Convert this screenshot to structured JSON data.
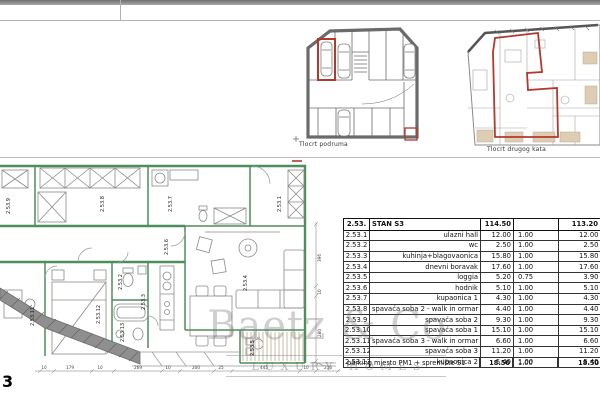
{
  "page_number": "3",
  "sheet": {
    "basement_plan_label": "Tlocrt podruma",
    "second_floor_plan_label": "Tlocrt drugog kata"
  },
  "watermark": {
    "brand": "Baetz & Co",
    "tagline": "LUXURY HOMES"
  },
  "colors": {
    "highlight_red": "#b03a2e",
    "wall_green": "#4e8d5c",
    "watermark_gray": "#9a9a9a"
  },
  "main_plan": {
    "room_labels": [
      "2.53.9",
      "2.53.8",
      "2.53.7",
      "2.53.1",
      "2.53.6",
      "2.53.4",
      "2.53.3",
      "2.53.2",
      "2.53.12",
      "2.53.11",
      "2.53.13",
      "2.53.5"
    ],
    "dims_bottom": [
      "10",
      "179",
      "10",
      "269",
      "10",
      "200",
      "25",
      "445",
      "10",
      "216"
    ],
    "dims_right": [
      "396",
      "10",
      "280"
    ]
  },
  "table": {
    "header": {
      "code": "2.53.",
      "name": "STAN S3",
      "area": "114.50",
      "coef": "",
      "net": "113.20"
    },
    "rows": [
      {
        "code": "2.53.1",
        "name": "ulazni hall",
        "area": "12.00",
        "coef": "1.00",
        "net": "12.00"
      },
      {
        "code": "2.53.2",
        "name": "wc",
        "area": "2.50",
        "coef": "1.00",
        "net": "2.50"
      },
      {
        "code": "2.53.3",
        "name": "kuhinja+blagovaonica",
        "area": "15.80",
        "coef": "1.00",
        "net": "15.80"
      },
      {
        "code": "2.53.4",
        "name": "dnevni boravak",
        "area": "17.60",
        "coef": "1.00",
        "net": "17.60"
      },
      {
        "code": "2.53.5",
        "name": "loggia",
        "area": "5.20",
        "coef": "0.75",
        "net": "3.90"
      },
      {
        "code": "2.53.6",
        "name": "hodnik",
        "area": "5.10",
        "coef": "1.00",
        "net": "5.10"
      },
      {
        "code": "2.53.7",
        "name": "kupaonica 1",
        "area": "4.30",
        "coef": "1.00",
        "net": "4.30"
      },
      {
        "code": "2.53.8",
        "name": "spavaća soba 2 - walk in ormar",
        "area": "4.40",
        "coef": "1.00",
        "net": "4.40"
      },
      {
        "code": "2.53.9",
        "name": "spavaća soba 2",
        "area": "9.30",
        "coef": "1.00",
        "net": "9.30"
      },
      {
        "code": "2.53.10",
        "name": "spavaća soba 1",
        "area": "15.10",
        "coef": "1.00",
        "net": "15.10"
      },
      {
        "code": "2.53.11",
        "name": "spavaća soba 3 - walk in ormar",
        "area": "6.60",
        "coef": "1.00",
        "net": "6.60"
      },
      {
        "code": "2.53.12",
        "name": "spavaća soba 3",
        "area": "11.20",
        "coef": "1.00",
        "net": "11.20"
      },
      {
        "code": "2.53.13",
        "name": "kupaonica 2",
        "area": "5.40",
        "coef": "1.00",
        "net": "5.40"
      }
    ],
    "parking": {
      "name": "parking mjesto PM1 + spremište S1",
      "area": "18.50",
      "coef": "1.00",
      "net": "18.50"
    }
  }
}
